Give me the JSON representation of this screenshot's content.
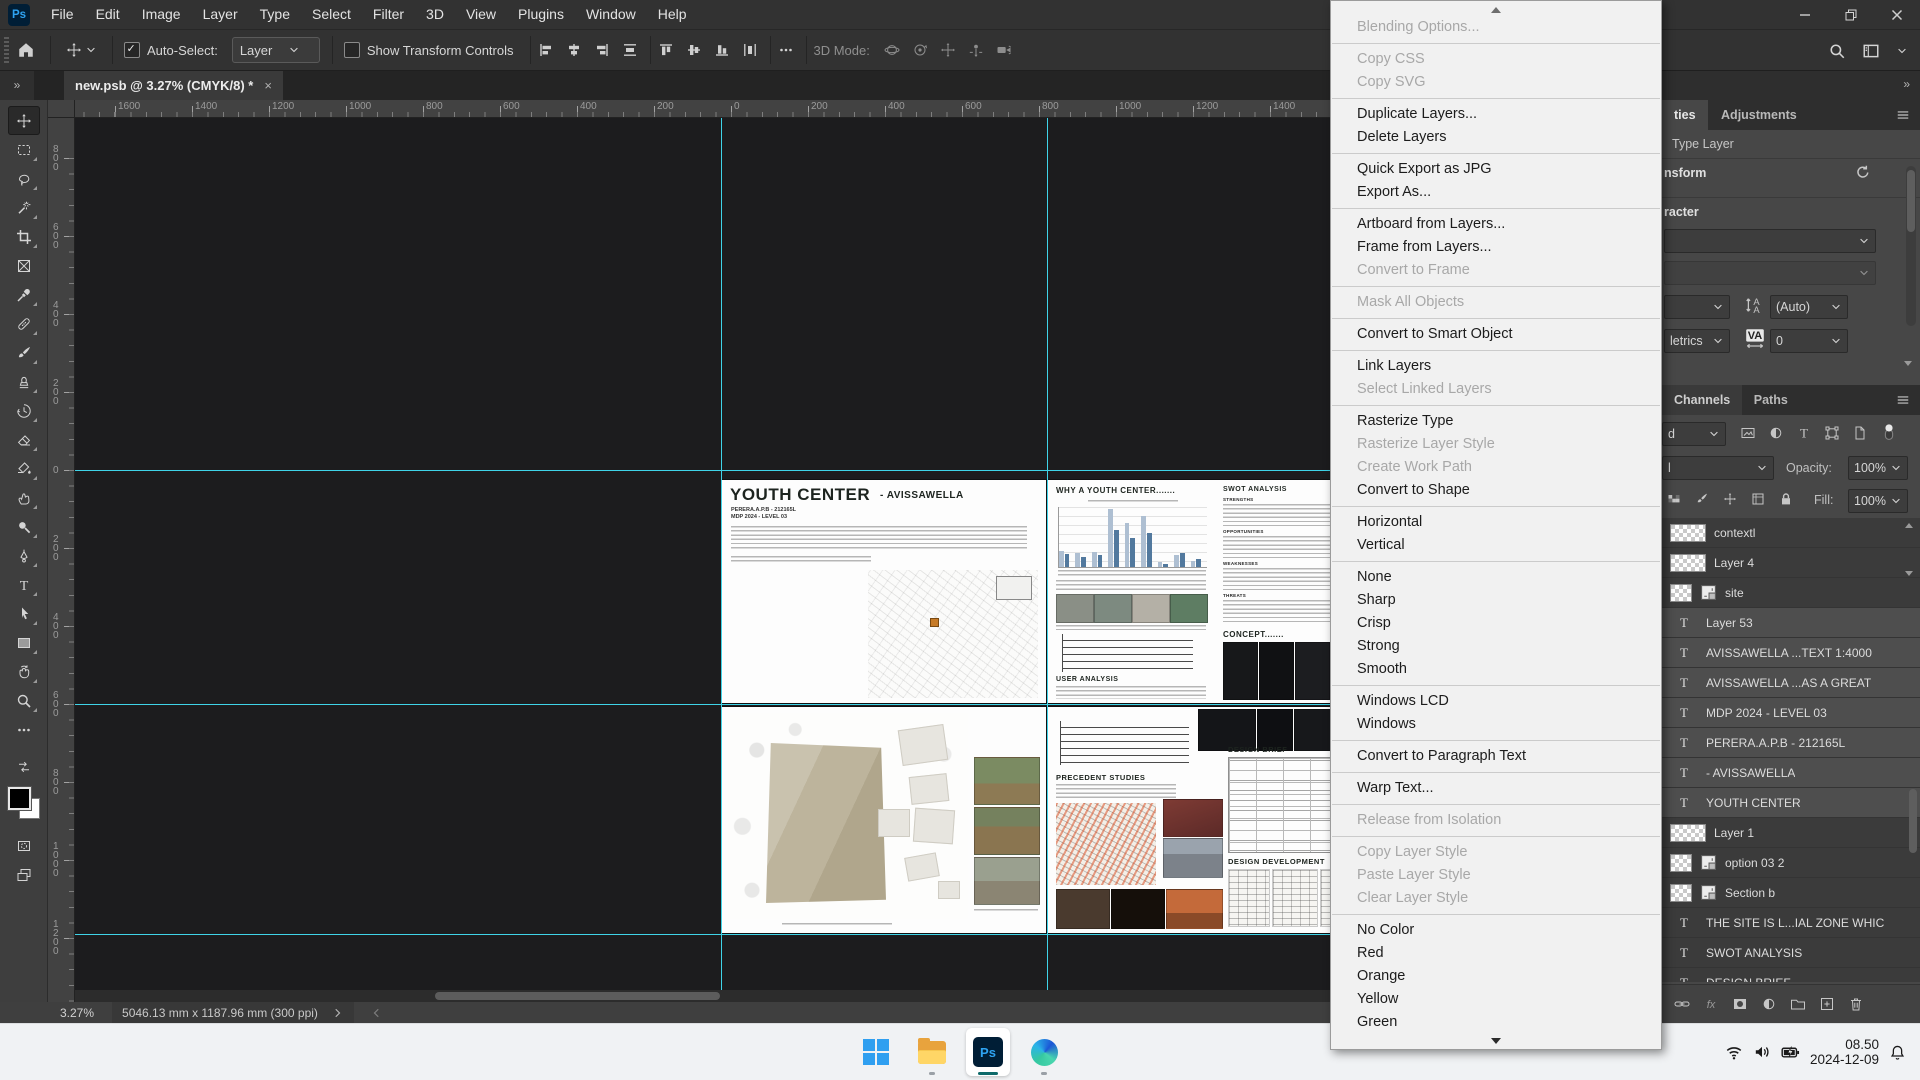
{
  "app": {
    "ps_logo": "Ps"
  },
  "menu_bar": {
    "items": [
      "File",
      "Edit",
      "Image",
      "Layer",
      "Type",
      "Select",
      "Filter",
      "3D",
      "View",
      "Plugins",
      "Window",
      "Help"
    ]
  },
  "options_bar": {
    "auto_select_label": "Auto-Select:",
    "auto_select_value": "Layer",
    "show_transform_label": "Show Transform Controls",
    "mode_label": "3D Mode:"
  },
  "document_tab": {
    "collapse_glyph": "»",
    "title": "new.psb @ 3.27% (CMYK/8) *",
    "close_glyph": "×"
  },
  "tools": {
    "list": [
      {
        "name": "move",
        "active": true
      },
      {
        "name": "marquee"
      },
      {
        "name": "lasso"
      },
      {
        "name": "object-selection"
      },
      {
        "name": "crop"
      },
      {
        "name": "frame"
      },
      {
        "name": "eyedropper"
      },
      {
        "name": "healing"
      },
      {
        "name": "brush"
      },
      {
        "name": "clone-stamp"
      },
      {
        "name": "history-brush"
      },
      {
        "name": "eraser"
      },
      {
        "name": "gradient-bucket"
      },
      {
        "name": "smudge"
      },
      {
        "name": "dodge"
      },
      {
        "name": "pen"
      },
      {
        "name": "type"
      },
      {
        "name": "path-select"
      },
      {
        "name": "rectangle"
      },
      {
        "name": "rotate-view"
      },
      {
        "name": "zoom"
      },
      {
        "name": "more"
      },
      {
        "name": "swap-mini"
      },
      {
        "name": "color-swatches"
      },
      {
        "name": "quick-mask"
      },
      {
        "name": "screen-mode"
      }
    ]
  },
  "rulers": {
    "horizontal": [
      "1600",
      "1400",
      "1200",
      "1000",
      "800",
      "600",
      "400",
      "200",
      "0",
      "200",
      "400",
      "600",
      "800",
      "1000",
      "1200",
      "1400"
    ],
    "vertical": [
      "800",
      "600",
      "400",
      "200",
      "0",
      "200",
      "400",
      "600",
      "800",
      "1000",
      "1200"
    ]
  },
  "canvas": {
    "guide_color": "#3fd4e8",
    "posters": {
      "top_left": {
        "title": "YOUTH CENTER",
        "subtitle": "- AVISSAWELLA",
        "author_line": "PERERA.A.P.B - 212165L",
        "course_line": "MDP 2024 - LEVEL 03"
      },
      "top_right": {
        "heading": "WHY A YOUTH CENTER.......",
        "user_analysis_heading": "USER ANALYSIS",
        "swot_heading": "SWOT ANALYSIS",
        "swot_sections": [
          "STRENGTHS",
          "OPPORTUNITIES",
          "WEAKNESSES",
          "THREATS"
        ],
        "concept_heading": "CONCEPT.......",
        "chart_bars": [
          28,
          22,
          24,
          18,
          26,
          20,
          100,
          64,
          76,
          50,
          88,
          58,
          8,
          6,
          20,
          24,
          10,
          14
        ]
      },
      "bottom_right": {
        "precedent_heading": "PRECEDENT STUDIES",
        "design_brief_heading": "DESIGN BRIEF",
        "design_dev_heading": "DESIGN DEVELOPMENT"
      }
    }
  },
  "context_menu": {
    "groups": [
      [
        {
          "label": "Blending Options...",
          "enabled": false
        }
      ],
      [
        {
          "label": "Copy CSS",
          "enabled": false
        },
        {
          "label": "Copy SVG",
          "enabled": false
        }
      ],
      [
        {
          "label": "Duplicate Layers...",
          "enabled": true
        },
        {
          "label": "Delete Layers",
          "enabled": true
        }
      ],
      [
        {
          "label": "Quick Export as JPG",
          "enabled": true
        },
        {
          "label": "Export As...",
          "enabled": true
        }
      ],
      [
        {
          "label": "Artboard from Layers...",
          "enabled": true
        },
        {
          "label": "Frame from Layers...",
          "enabled": true
        },
        {
          "label": "Convert to Frame",
          "enabled": false
        }
      ],
      [
        {
          "label": "Mask All Objects",
          "enabled": false
        }
      ],
      [
        {
          "label": "Convert to Smart Object",
          "enabled": true
        }
      ],
      [
        {
          "label": "Link Layers",
          "enabled": true
        },
        {
          "label": "Select Linked Layers",
          "enabled": false
        }
      ],
      [
        {
          "label": "Rasterize Type",
          "enabled": true
        },
        {
          "label": "Rasterize Layer Style",
          "enabled": false
        },
        {
          "label": "Create Work Path",
          "enabled": false
        },
        {
          "label": "Convert to Shape",
          "enabled": true
        }
      ],
      [
        {
          "label": "Horizontal",
          "enabled": true
        },
        {
          "label": "Vertical",
          "enabled": true
        }
      ],
      [
        {
          "label": "None",
          "enabled": true
        },
        {
          "label": "Sharp",
          "enabled": true
        },
        {
          "label": "Crisp",
          "enabled": true
        },
        {
          "label": "Strong",
          "enabled": true
        },
        {
          "label": "Smooth",
          "enabled": true
        }
      ],
      [
        {
          "label": "Windows LCD",
          "enabled": true
        },
        {
          "label": "Windows",
          "enabled": true
        }
      ],
      [
        {
          "label": "Convert to Paragraph Text",
          "enabled": true
        }
      ],
      [
        {
          "label": "Warp Text...",
          "enabled": true
        }
      ],
      [
        {
          "label": "Release from Isolation",
          "enabled": false
        }
      ],
      [
        {
          "label": "Copy Layer Style",
          "enabled": false
        },
        {
          "label": "Paste Layer Style",
          "enabled": false
        },
        {
          "label": "Clear Layer Style",
          "enabled": false
        }
      ],
      [
        {
          "label": "No Color",
          "enabled": true
        },
        {
          "label": "Red",
          "enabled": true
        },
        {
          "label": "Orange",
          "enabled": true
        },
        {
          "label": "Yellow",
          "enabled": true
        },
        {
          "label": "Green",
          "enabled": true
        }
      ]
    ]
  },
  "right_panel": {
    "collapse_glyph": "»",
    "properties": {
      "tab_properties_fragment": "ties",
      "tab_adjustments": "Adjustments",
      "layer_type": "Type Layer",
      "transform_fragment": "nsform",
      "character_fragment": "racter",
      "leading_value": "(Auto)",
      "kerning_fragment": "letrics",
      "tracking_value": "0"
    },
    "channels_tab": "Channels",
    "paths_tab": "Paths",
    "layers": {
      "kind_fragment": "d",
      "blend_fragment": "l",
      "opacity_label": "Opacity:",
      "opacity_value": "100%",
      "fill_label": "Fill:",
      "fill_value": "100%",
      "rows": [
        {
          "name": "contextl",
          "type": "raster",
          "selected": false
        },
        {
          "name": "Layer 4",
          "type": "raster",
          "selected": false
        },
        {
          "name": "site",
          "type": "smart",
          "selected": false
        },
        {
          "name": "Layer 53",
          "type": "text",
          "selected": true
        },
        {
          "name": "AVISSAWELLA ...TEXT 1:4000",
          "type": "text",
          "selected": true
        },
        {
          "name": "AVISSAWELLA ...AS A GREAT",
          "type": "text",
          "selected": true
        },
        {
          "name": "MDP 2024 - LEVEL 03",
          "type": "text",
          "selected": true
        },
        {
          "name": "PERERA.A.P.B - 212165L",
          "type": "text",
          "selected": true
        },
        {
          "name": "- AVISSAWELLA",
          "type": "text",
          "selected": true
        },
        {
          "name": "YOUTH CENTER",
          "type": "text",
          "selected": true
        },
        {
          "name": "Layer 1",
          "type": "raster",
          "selected": false
        },
        {
          "name": "option 03 2",
          "type": "smart",
          "selected": false
        },
        {
          "name": "Section b",
          "type": "smart",
          "selected": false
        },
        {
          "name": "THE SITE IS L...IAL ZONE WHIC",
          "type": "text",
          "selected": false
        },
        {
          "name": "SWOT ANALYSIS",
          "type": "text",
          "selected": false
        },
        {
          "name": "DESIGN BRIEF",
          "type": "text",
          "selected": false
        }
      ]
    }
  },
  "status_bar": {
    "zoom_level": "3.27%",
    "dimensions": "5046.13 mm x 1187.96 mm (300 ppi)"
  },
  "taskbar": {
    "ps_label": "Ps",
    "time": "08.50",
    "date": "2024-12-09"
  }
}
